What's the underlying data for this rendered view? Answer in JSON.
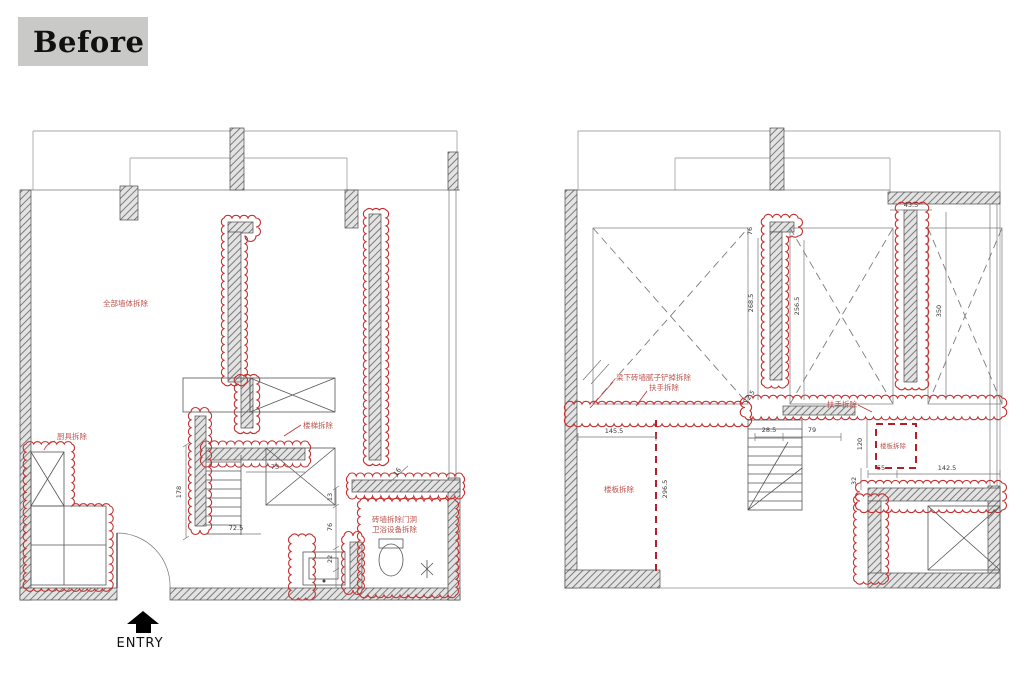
{
  "page": {
    "badge": "Before",
    "entry_label": "ENTRY"
  },
  "colors": {
    "demolition_red": "#c53030",
    "demolition_red_dash": "#b3202a",
    "demolition_text_red": "#c05650",
    "badge_bg": "#c9c9c7",
    "badge_text": "#111111"
  },
  "left_plan": {
    "labels": {
      "walls": "全部墙体拆除",
      "kitchen": "厨具拆除",
      "stair": "楼梯拆除",
      "bath_line1": "砖墙拆除门洞",
      "bath_line2": "卫浴设备拆除"
    },
    "dims": {
      "d178": "178",
      "d72_5": "72.5",
      "d73": "73",
      "d13": "13",
      "d76": "76",
      "d22": "22",
      "d16": "16"
    }
  },
  "right_plan": {
    "labels": {
      "beam_wall": "梁下砖墙腻子铲掉拆除",
      "handrail_1": "扶手拆除",
      "handrail_2": "扶手拆除",
      "slab_1": "楼板拆除",
      "slab_2": "楼板拆除"
    },
    "dims": {
      "d43_5": "43.5",
      "d76": "76",
      "d268_5": "268.5",
      "d256_5": "256.5",
      "d350": "350",
      "d72_5": "72.5",
      "d28_5": "28.5",
      "d79": "79",
      "d145_5": "145.5",
      "d296_5": "296.5",
      "d120": "120",
      "d32": "32",
      "d55": "55",
      "d142_5": "142.5"
    }
  }
}
